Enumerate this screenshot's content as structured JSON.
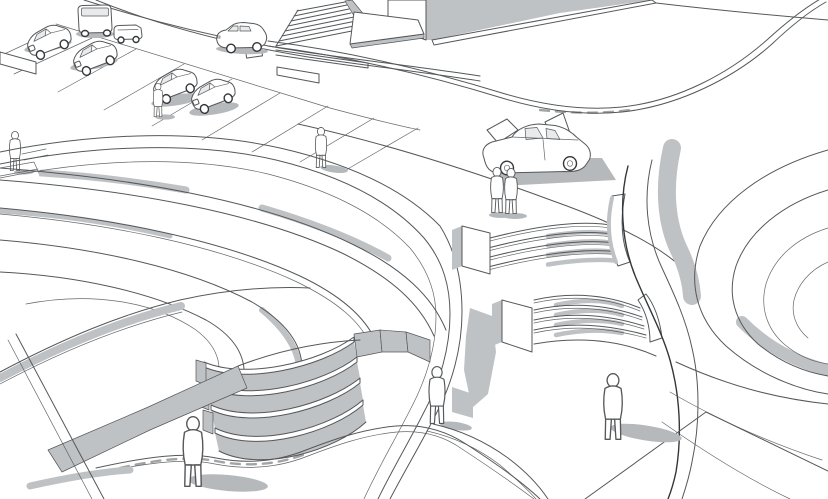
{
  "meta": {
    "scene_title": "Architectural concept sketch - terraced plaza",
    "description": "Monochrome 3D line rendering of a public plaza: curved amphitheater steps and two landscaped terraced mounds, a building with wide entry stairs, an angled parking lot with cars, a road with a passing car, a stopped hatchback with open doors, and eight human figures.",
    "render_style": "white line drawing with flat gray shading"
  },
  "colors": {
    "background": "#ffffff",
    "line": "#55585a",
    "line_dark": "#34373a",
    "shade": "#bfc2c4",
    "shade_dark": "#aeb1b3",
    "shadow": "#b6b9bb",
    "glass": "#e9eaeb"
  },
  "scene": {
    "buildings_count": 1,
    "vehicles": {
      "parked_count": 6,
      "moving_count": 1,
      "open_doors_count": 1,
      "total": 8
    },
    "people_count": 8,
    "stair_flights": [
      "building-entry-stairs",
      "upper-curved-steps",
      "lower-curved-steps",
      "amphitheater-steps"
    ],
    "landscape_features": [
      "left-terraced-mound",
      "right-terraced-mound",
      "curved-walkway",
      "parking-stalls",
      "plaza-curb",
      "sloped-ramp-band"
    ]
  }
}
